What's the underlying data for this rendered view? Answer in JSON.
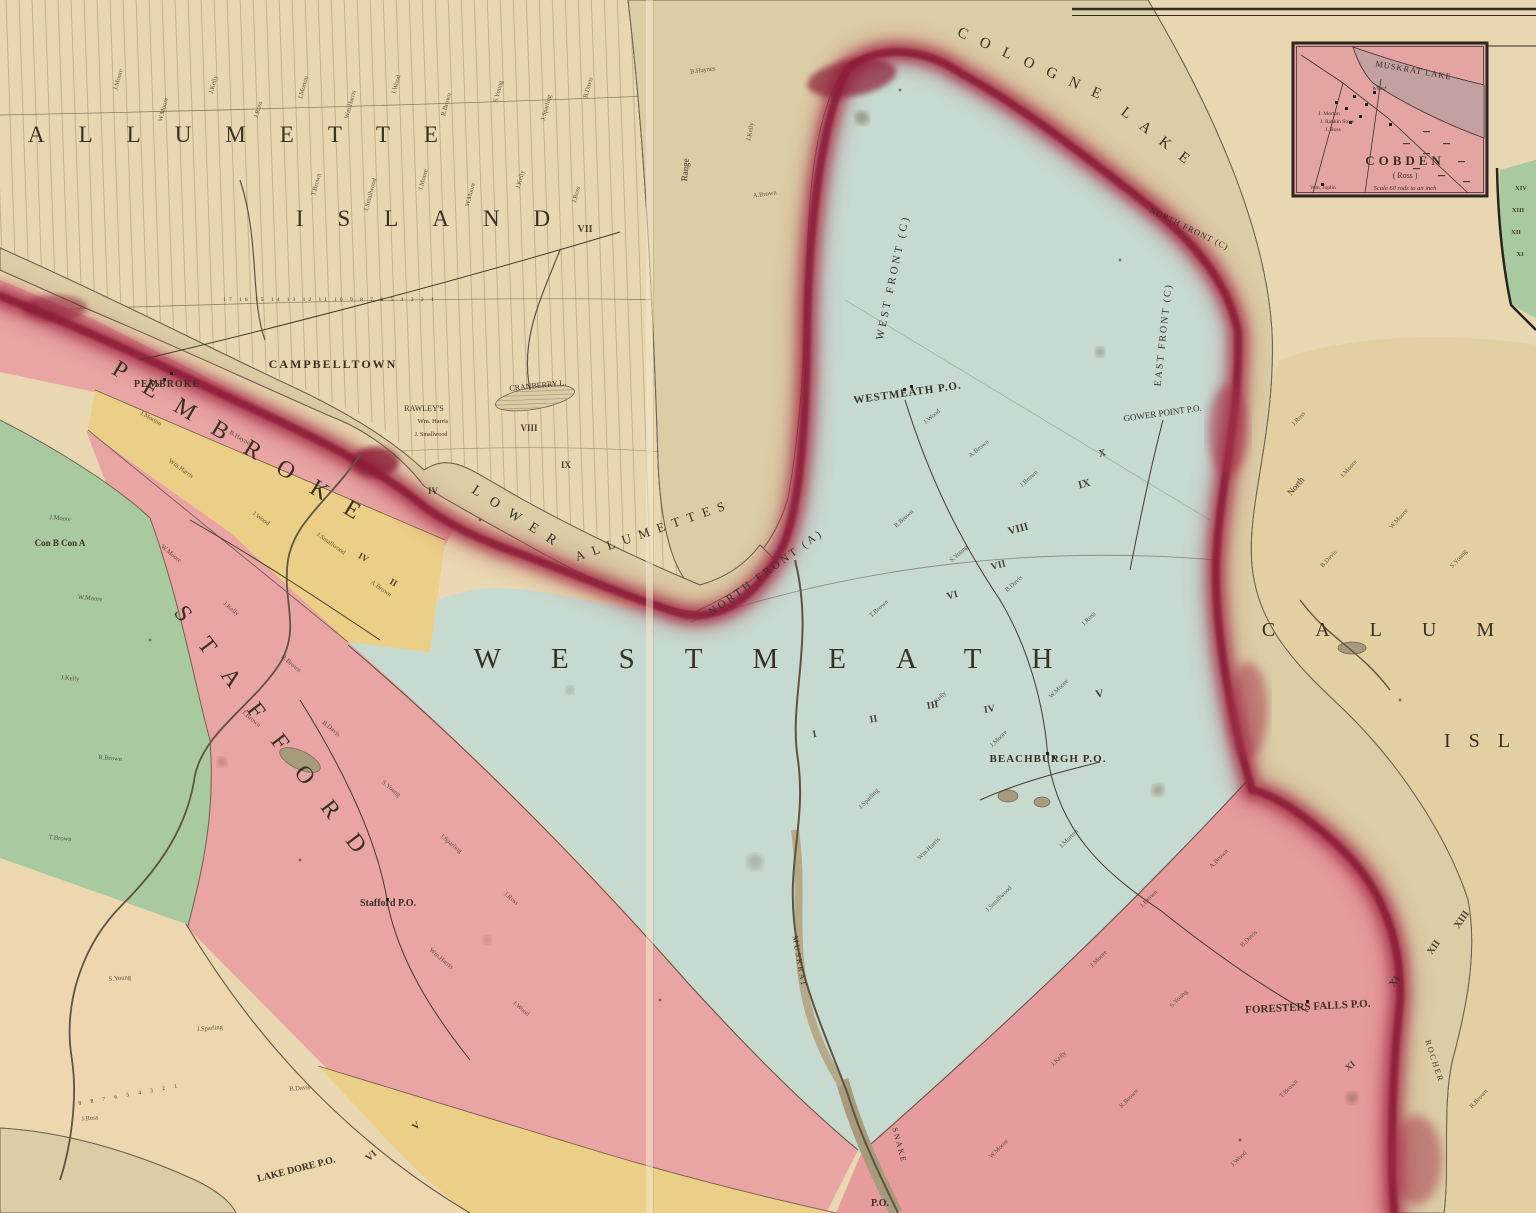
{
  "palette": {
    "parchment": "#e8d7b0",
    "parchment_deep": "#e2cfa2",
    "water_base": "#dbcda6",
    "water_line": "#8a8068",
    "teal": "#c7dacf",
    "pink": "#e8a5a3",
    "pink_ross": "#e69c9c",
    "yellow": "#eccf86",
    "green": "#a9c9a1",
    "tan": "#ecd7ae",
    "red_rim": "#a63049",
    "red_deep": "#8c1f39",
    "ink": "#3a3126",
    "inset_pink": "#e4a5a2"
  },
  "labels": [
    {
      "id": "island-name-line1",
      "t": "ALLUMETTE",
      "x": 250,
      "y": 142,
      "s": 23,
      "ls": 34
    },
    {
      "id": "island-name-line2",
      "t": "ISLAND",
      "x": 440,
      "y": 226,
      "s": 23,
      "ls": 34
    },
    {
      "id": "cologne-lake-1",
      "t": "COLOGNE",
      "x": 1034,
      "y": 70,
      "s": 15,
      "r": 24,
      "ls": 14
    },
    {
      "id": "cologne-lake-2",
      "t": "LAKE",
      "x": 1158,
      "y": 143,
      "s": 15,
      "r": 38,
      "ls": 14
    },
    {
      "id": "lower-allumettes-1",
      "t": "LOWER",
      "x": 517,
      "y": 522,
      "s": 14,
      "r": 33,
      "ls": 12
    },
    {
      "id": "lower-allumettes-2",
      "t": "ALLUMETTES",
      "x": 655,
      "y": 534,
      "s": 13,
      "r": -19,
      "ls": 8
    },
    {
      "id": "westmeath-township-name",
      "t": "WESTMEATH",
      "x": 788,
      "y": 668,
      "s": 29,
      "ls": 50
    },
    {
      "id": "pembroke-township-name",
      "t": "PEMBROKE",
      "x": 242,
      "y": 452,
      "s": 24,
      "r": 31,
      "ls": 22
    },
    {
      "id": "stafford-township-name",
      "t": "STAFFORD",
      "x": 272,
      "y": 744,
      "s": 24,
      "r": 53,
      "ls": 26
    },
    {
      "id": "calumet-name-line1",
      "t": "CALUM",
      "x": 1398,
      "y": 636,
      "s": 20,
      "ls": 40
    },
    {
      "id": "calumet-name-line2",
      "t": "ISL",
      "x": 1486,
      "y": 747,
      "s": 20,
      "ls": 18
    },
    {
      "id": "campbelltown-label",
      "t": "CAMPBELLTOWN",
      "x": 333,
      "y": 368,
      "s": 12,
      "ls": 2,
      "w": "bold"
    },
    {
      "id": "pembroke-town-label",
      "t": "PEMBROKE",
      "x": 167,
      "y": 387,
      "s": 10,
      "w": "bold",
      "ls": 1
    },
    {
      "id": "rawleys-label",
      "t": "RAWLEY'S",
      "x": 424,
      "y": 411,
      "s": 8
    },
    {
      "id": "wm-harris-label",
      "t": "Wm. Harris",
      "x": 433,
      "y": 423,
      "s": 6.5
    },
    {
      "id": "smallwood-label",
      "t": "J. Smallwood",
      "x": 431,
      "y": 436,
      "s": 6
    },
    {
      "id": "stafford-po-label",
      "t": "Stafford P.O.",
      "x": 388,
      "y": 906,
      "s": 10,
      "w": "bold"
    },
    {
      "id": "westmeath-po-label",
      "t": "WESTMEATH P.O.",
      "x": 908,
      "y": 396,
      "s": 11,
      "r": -8,
      "w": "bold",
      "ls": 1
    },
    {
      "id": "gower-point-po-label",
      "t": "GOWER POINT P.O.",
      "x": 1163,
      "y": 416,
      "s": 9,
      "r": -8
    },
    {
      "id": "beachburgh-po-label",
      "t": "BEACHBURGH P.O.",
      "x": 1048,
      "y": 762,
      "s": 11,
      "w": "bold",
      "ls": 1
    },
    {
      "id": "foresters-falls-po-label",
      "t": "FORESTERS FALLS P.O.",
      "x": 1308,
      "y": 1010,
      "s": 11,
      "r": -3,
      "w": "bold"
    },
    {
      "id": "lake-dore-po-label",
      "t": "LAKE DORE P.O.",
      "x": 297,
      "y": 1172,
      "s": 10,
      "r": -14,
      "w": "bold"
    },
    {
      "id": "west-front-label",
      "t": "WEST FRONT (C)",
      "x": 896,
      "y": 278,
      "s": 11,
      "r": -78,
      "ls": 3
    },
    {
      "id": "east-front-label",
      "t": "EAST FRONT (C)",
      "x": 1166,
      "y": 335,
      "s": 10,
      "r": -84,
      "ls": 2
    },
    {
      "id": "north-front-c-label",
      "t": "NORTH FRONT (C)",
      "x": 1188,
      "y": 231,
      "s": 8.5,
      "r": 26,
      "ls": 1
    },
    {
      "id": "north-front-a-label",
      "t": "NORTH FRONT (A)",
      "x": 768,
      "y": 575,
      "s": 11,
      "r": -36,
      "ls": 3
    },
    {
      "id": "cranberry-lake-label",
      "t": "CRANBERRY L.",
      "x": 538,
      "y": 388,
      "s": 8,
      "r": -6
    },
    {
      "id": "north-small-label",
      "t": "North",
      "x": 1298,
      "y": 488,
      "s": 9,
      "r": -50
    },
    {
      "id": "range-label",
      "t": "Range",
      "x": 688,
      "y": 170,
      "s": 9,
      "r": -85
    },
    {
      "id": "rocher-channel-label",
      "t": "ROCHER",
      "x": 1432,
      "y": 1062,
      "s": 8,
      "r": 72,
      "ls": 2
    },
    {
      "id": "con-b-con-a-label",
      "t": "Con B Con A",
      "x": 60,
      "y": 546,
      "s": 9,
      "w": "bold"
    },
    {
      "id": "muskrat-river-label",
      "t": "MUSKRAT",
      "x": 797,
      "y": 962,
      "s": 8,
      "r": 80,
      "ls": 2
    },
    {
      "id": "snake-river-label",
      "t": "SNAKE",
      "x": 897,
      "y": 1146,
      "s": 8,
      "r": 75,
      "ls": 2
    },
    {
      "id": "po-cutoff-label",
      "t": "P.O.",
      "x": 880,
      "y": 1206,
      "s": 10,
      "w": "bold"
    },
    {
      "id": "island-lot-numbers",
      "t": "17 16 15 14 13 12 11 10 9 8 7 6 5 4 3 2 1",
      "x": 330,
      "y": 301,
      "s": 5.5,
      "ls": 3
    },
    {
      "id": "tan-lot-numbers",
      "t": "9 8 7 6 5 4 3 2 1",
      "x": 130,
      "y": 1096,
      "s": 5.5,
      "r": -10,
      "ls": 4
    }
  ],
  "numerals": [
    {
      "t": "VII",
      "x": 585,
      "y": 232,
      "s": 10
    },
    {
      "t": "VIII",
      "x": 529,
      "y": 431,
      "s": 9
    },
    {
      "t": "IX",
      "x": 566,
      "y": 468,
      "s": 9
    },
    {
      "t": "IV",
      "x": 433,
      "y": 494,
      "s": 9
    },
    {
      "t": "IX",
      "x": 1085,
      "y": 487,
      "r": -15,
      "s": 11
    },
    {
      "t": "VIII",
      "x": 1019,
      "y": 532,
      "r": -15,
      "s": 11
    },
    {
      "t": "VII",
      "x": 999,
      "y": 568,
      "r": -15,
      "s": 10
    },
    {
      "t": "VI",
      "x": 953,
      "y": 598,
      "r": -15,
      "s": 10
    },
    {
      "t": "V",
      "x": 1100,
      "y": 697,
      "r": -10,
      "s": 11
    },
    {
      "t": "IV",
      "x": 990,
      "y": 712,
      "r": -10,
      "s": 10
    },
    {
      "t": "III",
      "x": 933,
      "y": 708,
      "r": -10,
      "s": 10
    },
    {
      "t": "II",
      "x": 874,
      "y": 722,
      "r": -10,
      "s": 10
    },
    {
      "t": "I",
      "x": 815,
      "y": 737,
      "r": -10,
      "s": 10
    },
    {
      "t": "X",
      "x": 1103,
      "y": 456,
      "r": -15,
      "s": 10
    },
    {
      "t": "V",
      "x": 418,
      "y": 1128,
      "r": -40,
      "s": 10
    },
    {
      "t": "VI",
      "x": 373,
      "y": 1158,
      "r": -40,
      "s": 10
    },
    {
      "t": "XI",
      "x": 1397,
      "y": 983,
      "r": -55,
      "s": 10
    },
    {
      "t": "XII",
      "x": 1436,
      "y": 949,
      "r": -55,
      "s": 10
    },
    {
      "t": "XIII",
      "x": 1464,
      "y": 921,
      "r": -55,
      "s": 10
    },
    {
      "t": "XI",
      "x": 1352,
      "y": 1068,
      "r": -40,
      "s": 9
    },
    {
      "t": "XIV",
      "x": 1521,
      "y": 190,
      "s": 6.5
    },
    {
      "t": "XIII",
      "x": 1518,
      "y": 212,
      "s": 6.5
    },
    {
      "t": "XII",
      "x": 1516,
      "y": 234,
      "s": 6.5
    },
    {
      "t": "XI",
      "x": 1520,
      "y": 256,
      "s": 6.5
    },
    {
      "t": "II",
      "x": 392,
      "y": 585,
      "r": 30,
      "s": 9
    },
    {
      "t": "IV",
      "x": 362,
      "y": 560,
      "r": 30,
      "s": 9
    }
  ],
  "settlers": [
    {
      "t": "J.Moore",
      "x": 120,
      "y": 80,
      "r": -75
    },
    {
      "t": "W.Moore",
      "x": 165,
      "y": 110,
      "r": -75
    },
    {
      "t": "J.Kelly",
      "x": 215,
      "y": 85,
      "r": -75
    },
    {
      "t": "J.Ross",
      "x": 260,
      "y": 110,
      "r": -75
    },
    {
      "t": "J.Morton",
      "x": 305,
      "y": 88,
      "r": -75
    },
    {
      "t": "Wm.Harris",
      "x": 352,
      "y": 105,
      "r": -75
    },
    {
      "t": "J.Wood",
      "x": 398,
      "y": 85,
      "r": -75
    },
    {
      "t": "R.Brown",
      "x": 448,
      "y": 105,
      "r": -75
    },
    {
      "t": "S.Young",
      "x": 500,
      "y": 92,
      "r": -75
    },
    {
      "t": "J.Sparling",
      "x": 548,
      "y": 108,
      "r": -75
    },
    {
      "t": "B.Davis",
      "x": 590,
      "y": 88,
      "r": -75
    },
    {
      "t": "T.Brown",
      "x": 318,
      "y": 185,
      "r": -75
    },
    {
      "t": "J.Smallwood",
      "x": 372,
      "y": 195,
      "r": -75
    },
    {
      "t": "J.Moore",
      "x": 425,
      "y": 180,
      "r": -75
    },
    {
      "t": "W.Moore",
      "x": 472,
      "y": 195,
      "r": -75
    },
    {
      "t": "J.Kelly",
      "x": 522,
      "y": 180,
      "r": -75
    },
    {
      "t": "J.Ross",
      "x": 578,
      "y": 195,
      "r": -75
    },
    {
      "t": "B.Haynes",
      "x": 703,
      "y": 72,
      "r": -8
    },
    {
      "t": "A.Brown",
      "x": 765,
      "y": 196,
      "r": -8
    },
    {
      "t": "J.Kelly",
      "x": 752,
      "y": 132,
      "r": -80
    },
    {
      "t": "J.Wood",
      "x": 933,
      "y": 418,
      "r": -40
    },
    {
      "t": "A.Brown",
      "x": 980,
      "y": 450,
      "r": -40
    },
    {
      "t": "J.Brown",
      "x": 1030,
      "y": 480,
      "r": -42
    },
    {
      "t": "R.Brown",
      "x": 905,
      "y": 520,
      "r": -42
    },
    {
      "t": "S.Young",
      "x": 960,
      "y": 555,
      "r": -42
    },
    {
      "t": "B.Davis",
      "x": 1015,
      "y": 585,
      "r": -42
    },
    {
      "t": "T.Brown",
      "x": 880,
      "y": 610,
      "r": -42
    },
    {
      "t": "J.Kelly",
      "x": 940,
      "y": 700,
      "r": -45
    },
    {
      "t": "J.Moore",
      "x": 1000,
      "y": 740,
      "r": -45
    },
    {
      "t": "W.Moore",
      "x": 1060,
      "y": 690,
      "r": -45
    },
    {
      "t": "J.Ross",
      "x": 1090,
      "y": 620,
      "r": -45
    },
    {
      "t": "J.Sparling",
      "x": 870,
      "y": 800,
      "r": -45
    },
    {
      "t": "Wm.Harris",
      "x": 930,
      "y": 850,
      "r": -45
    },
    {
      "t": "J.Smallwood",
      "x": 1000,
      "y": 900,
      "r": -45
    },
    {
      "t": "J.Morton",
      "x": 1070,
      "y": 840,
      "r": -45
    },
    {
      "t": "W.Moore",
      "x": 170,
      "y": 555,
      "r": 40
    },
    {
      "t": "J.Kelly",
      "x": 230,
      "y": 610,
      "r": 40
    },
    {
      "t": "R.Brown",
      "x": 290,
      "y": 665,
      "r": 40
    },
    {
      "t": "T.Brown",
      "x": 250,
      "y": 720,
      "r": 40
    },
    {
      "t": "B.Davis",
      "x": 330,
      "y": 730,
      "r": 40
    },
    {
      "t": "S.Young",
      "x": 390,
      "y": 790,
      "r": 40
    },
    {
      "t": "J.Sparling",
      "x": 450,
      "y": 845,
      "r": 40
    },
    {
      "t": "J.Ross",
      "x": 510,
      "y": 900,
      "r": 40
    },
    {
      "t": "Wm.Harris",
      "x": 440,
      "y": 960,
      "r": 40
    },
    {
      "t": "J.Wood",
      "x": 520,
      "y": 1010,
      "r": 40
    },
    {
      "t": "J.Brown",
      "x": 1150,
      "y": 900,
      "r": -45
    },
    {
      "t": "A.Brown",
      "x": 1220,
      "y": 860,
      "r": -45
    },
    {
      "t": "J.Moore",
      "x": 1100,
      "y": 960,
      "r": -45
    },
    {
      "t": "S.Young",
      "x": 1180,
      "y": 1000,
      "r": -45
    },
    {
      "t": "B.Davis",
      "x": 1250,
      "y": 940,
      "r": -45
    },
    {
      "t": "J.Kelly",
      "x": 1060,
      "y": 1060,
      "r": -45
    },
    {
      "t": "R.Brown",
      "x": 1130,
      "y": 1100,
      "r": -45
    },
    {
      "t": "T.Brown",
      "x": 1290,
      "y": 1090,
      "r": -45
    },
    {
      "t": "W.Moore",
      "x": 1000,
      "y": 1150,
      "r": -45
    },
    {
      "t": "J.Wood",
      "x": 1240,
      "y": 1160,
      "r": -45
    },
    {
      "t": "J.Ross",
      "x": 1300,
      "y": 420,
      "r": -48
    },
    {
      "t": "J.Moore",
      "x": 1350,
      "y": 470,
      "r": -48
    },
    {
      "t": "W.Moore",
      "x": 1400,
      "y": 520,
      "r": -48
    },
    {
      "t": "S.Young",
      "x": 1460,
      "y": 560,
      "r": -48
    },
    {
      "t": "B.Davis",
      "x": 1330,
      "y": 560,
      "r": -48
    },
    {
      "t": "R.Brown",
      "x": 1480,
      "y": 1100,
      "r": -48
    },
    {
      "t": "J.Moore",
      "x": 60,
      "y": 520,
      "r": 5
    },
    {
      "t": "W.Moore",
      "x": 90,
      "y": 600,
      "r": 5
    },
    {
      "t": "J.Kelly",
      "x": 70,
      "y": 680,
      "r": 5
    },
    {
      "t": "R.Brown",
      "x": 110,
      "y": 760,
      "r": 5
    },
    {
      "t": "T.Brown",
      "x": 60,
      "y": 840,
      "r": 5
    },
    {
      "t": "S.Young",
      "x": 120,
      "y": 980,
      "r": -5
    },
    {
      "t": "J.Sparling",
      "x": 210,
      "y": 1030,
      "r": -5
    },
    {
      "t": "B.Davis",
      "x": 300,
      "y": 1090,
      "r": -5
    },
    {
      "t": "J.Ross",
      "x": 90,
      "y": 1120,
      "r": -5
    },
    {
      "t": "Wm.Harris",
      "x": 180,
      "y": 470,
      "r": 35
    },
    {
      "t": "J.Wood",
      "x": 260,
      "y": 520,
      "r": 35
    },
    {
      "t": "J.Smallwood",
      "x": 330,
      "y": 545,
      "r": 35
    },
    {
      "t": "A.Brown",
      "x": 380,
      "y": 590,
      "r": 35
    },
    {
      "t": "J.Morton",
      "x": 150,
      "y": 420,
      "r": 30
    },
    {
      "t": "B.Haynes",
      "x": 240,
      "y": 440,
      "r": 30
    }
  ],
  "inset": {
    "labels": [
      {
        "id": "inset-lake-name",
        "t": "MUSKRAT LAKE",
        "x": 120,
        "y": 30,
        "r": 10,
        "s": 8.5,
        "ls": 1
      },
      {
        "id": "inset-wharf-label",
        "t": "Wharf",
        "x": 86,
        "y": 47,
        "s": 5.5,
        "style": "italic"
      },
      {
        "id": "inset-resident-1",
        "t": "J. Morton",
        "x": 36,
        "y": 72,
        "s": 5.5
      },
      {
        "id": "inset-resident-2",
        "t": "J. Rankin Store",
        "x": 44,
        "y": 80,
        "s": 5.5
      },
      {
        "id": "inset-resident-3",
        "t": "J. Ross",
        "x": 40,
        "y": 88,
        "s": 5.5
      },
      {
        "id": "inset-resident-4",
        "t": "Wm. Joplin",
        "x": 30,
        "y": 146,
        "s": 5.5
      },
      {
        "id": "inset-title",
        "t": "COBDEN",
        "x": 112,
        "y": 122,
        "s": 13,
        "ls": 4,
        "w": "bold"
      },
      {
        "id": "inset-subtitle",
        "t": "( Ross )",
        "x": 112,
        "y": 135,
        "s": 8
      },
      {
        "id": "inset-scale-note",
        "t": "Scale 60 rods to an inch",
        "x": 112,
        "y": 147,
        "s": 6.5,
        "style": "italic"
      }
    ]
  }
}
